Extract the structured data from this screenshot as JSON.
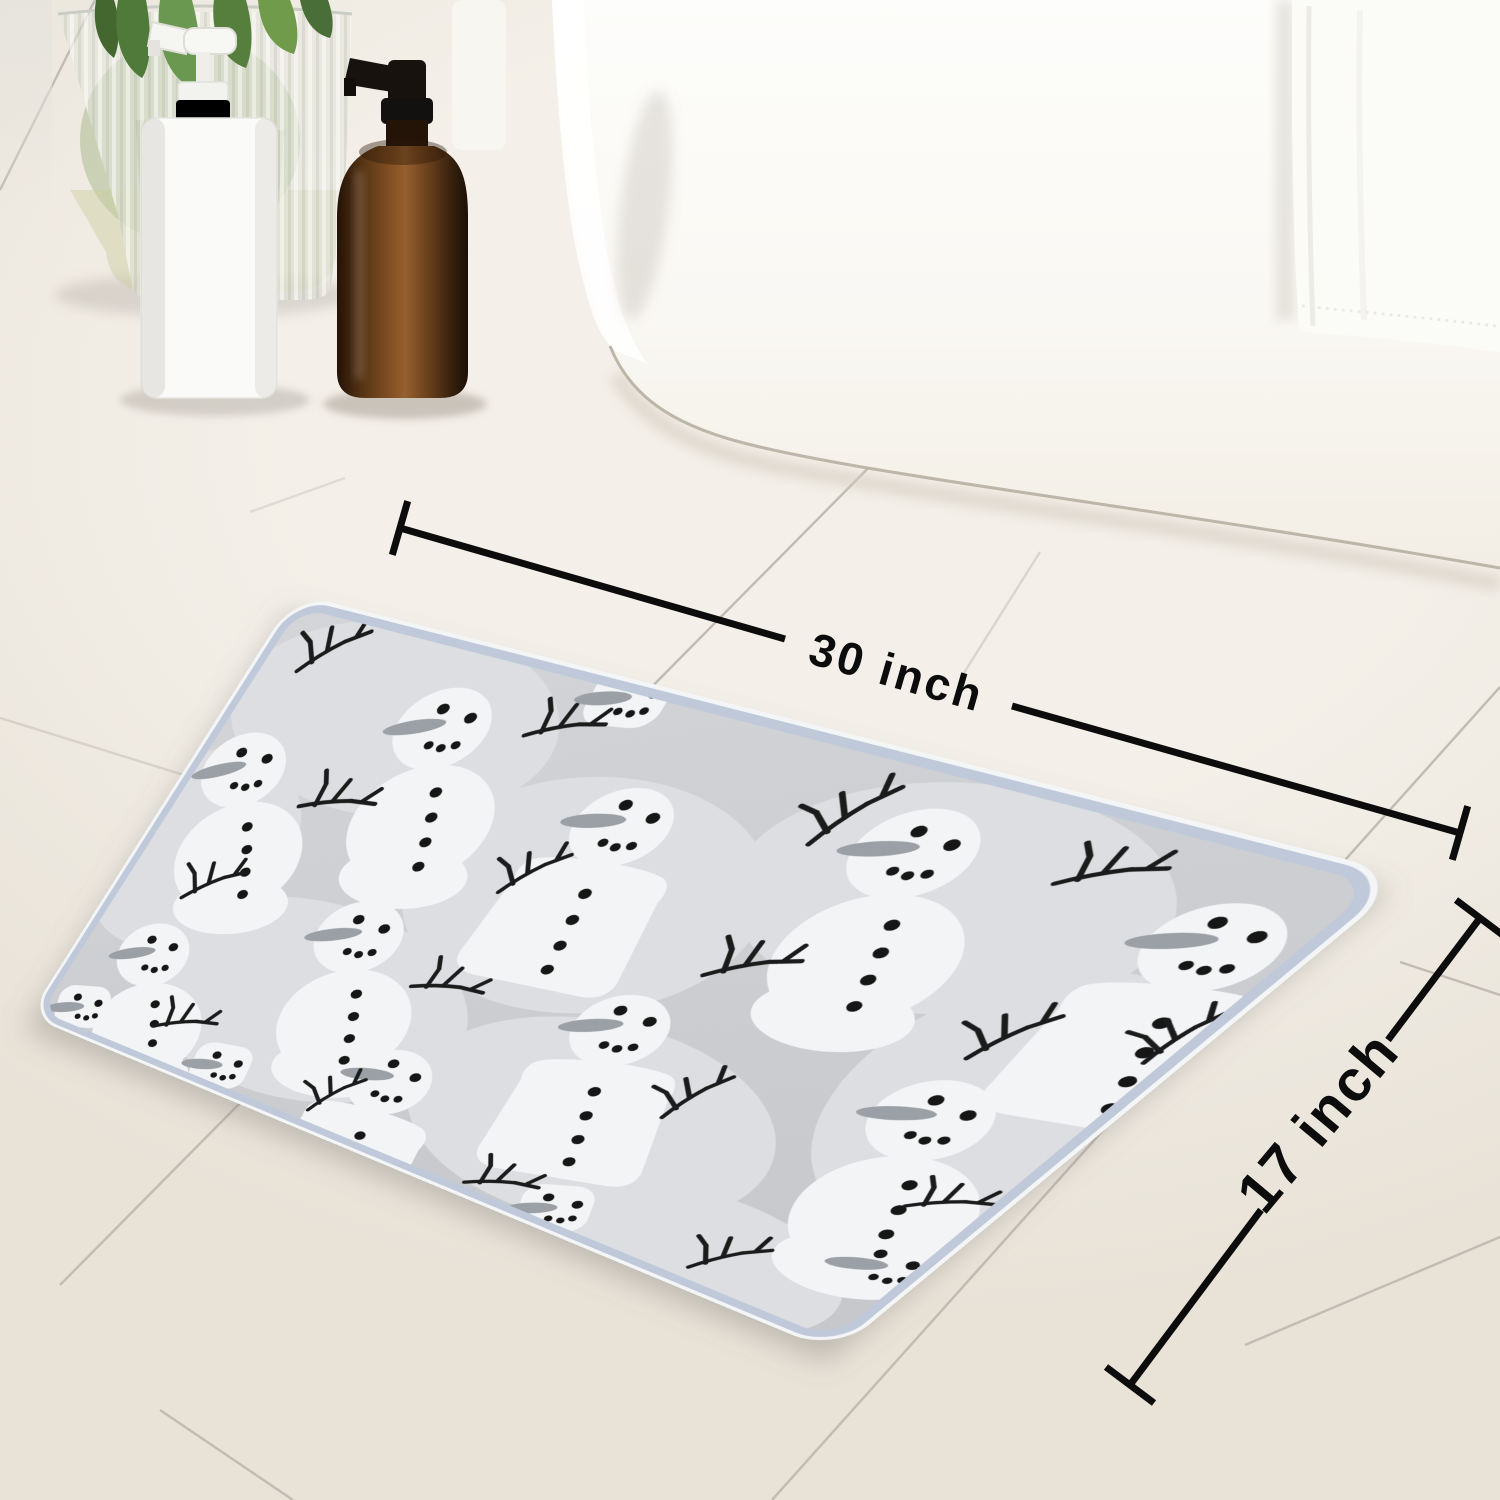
{
  "annotations": {
    "width": {
      "label": "30 inch"
    },
    "height": {
      "label": "17 inch"
    }
  },
  "colors": {
    "floor_base": "#f4f0e9",
    "floor_shade": "#e8e2d7",
    "grout": "#c2bdb4",
    "wall": "#e9e6e0",
    "tub": "#fcfbf7",
    "tub_edge": "#b3ab9e",
    "towel": "#fbfbf8",
    "vase_glass": "#e3e6dd",
    "leaf": "#5d8a3e",
    "white_bottle": "#fafaf8",
    "amber": "#7b4a22",
    "pump_black": "#17120d",
    "mat_base": "#cbcdd0",
    "mat_blob": "#dcdee1",
    "mat_snow": "#f3f4f6",
    "mat_binding": "#bfc9da",
    "twig": "#1b1b1b",
    "nose": "#9aa0a6",
    "dot": "#161616",
    "dimension": "#0c0c0c"
  },
  "icons": [
    "bathtub",
    "bath-towel",
    "glass-vase",
    "plant-leaves",
    "white-pump-bottle",
    "amber-pump-bottle",
    "snowman-bath-mat",
    "snowman-icon",
    "snowman-bucket-icon",
    "snowman-head-icon",
    "twig-icon",
    "dimension-line-width",
    "dimension-line-height"
  ]
}
